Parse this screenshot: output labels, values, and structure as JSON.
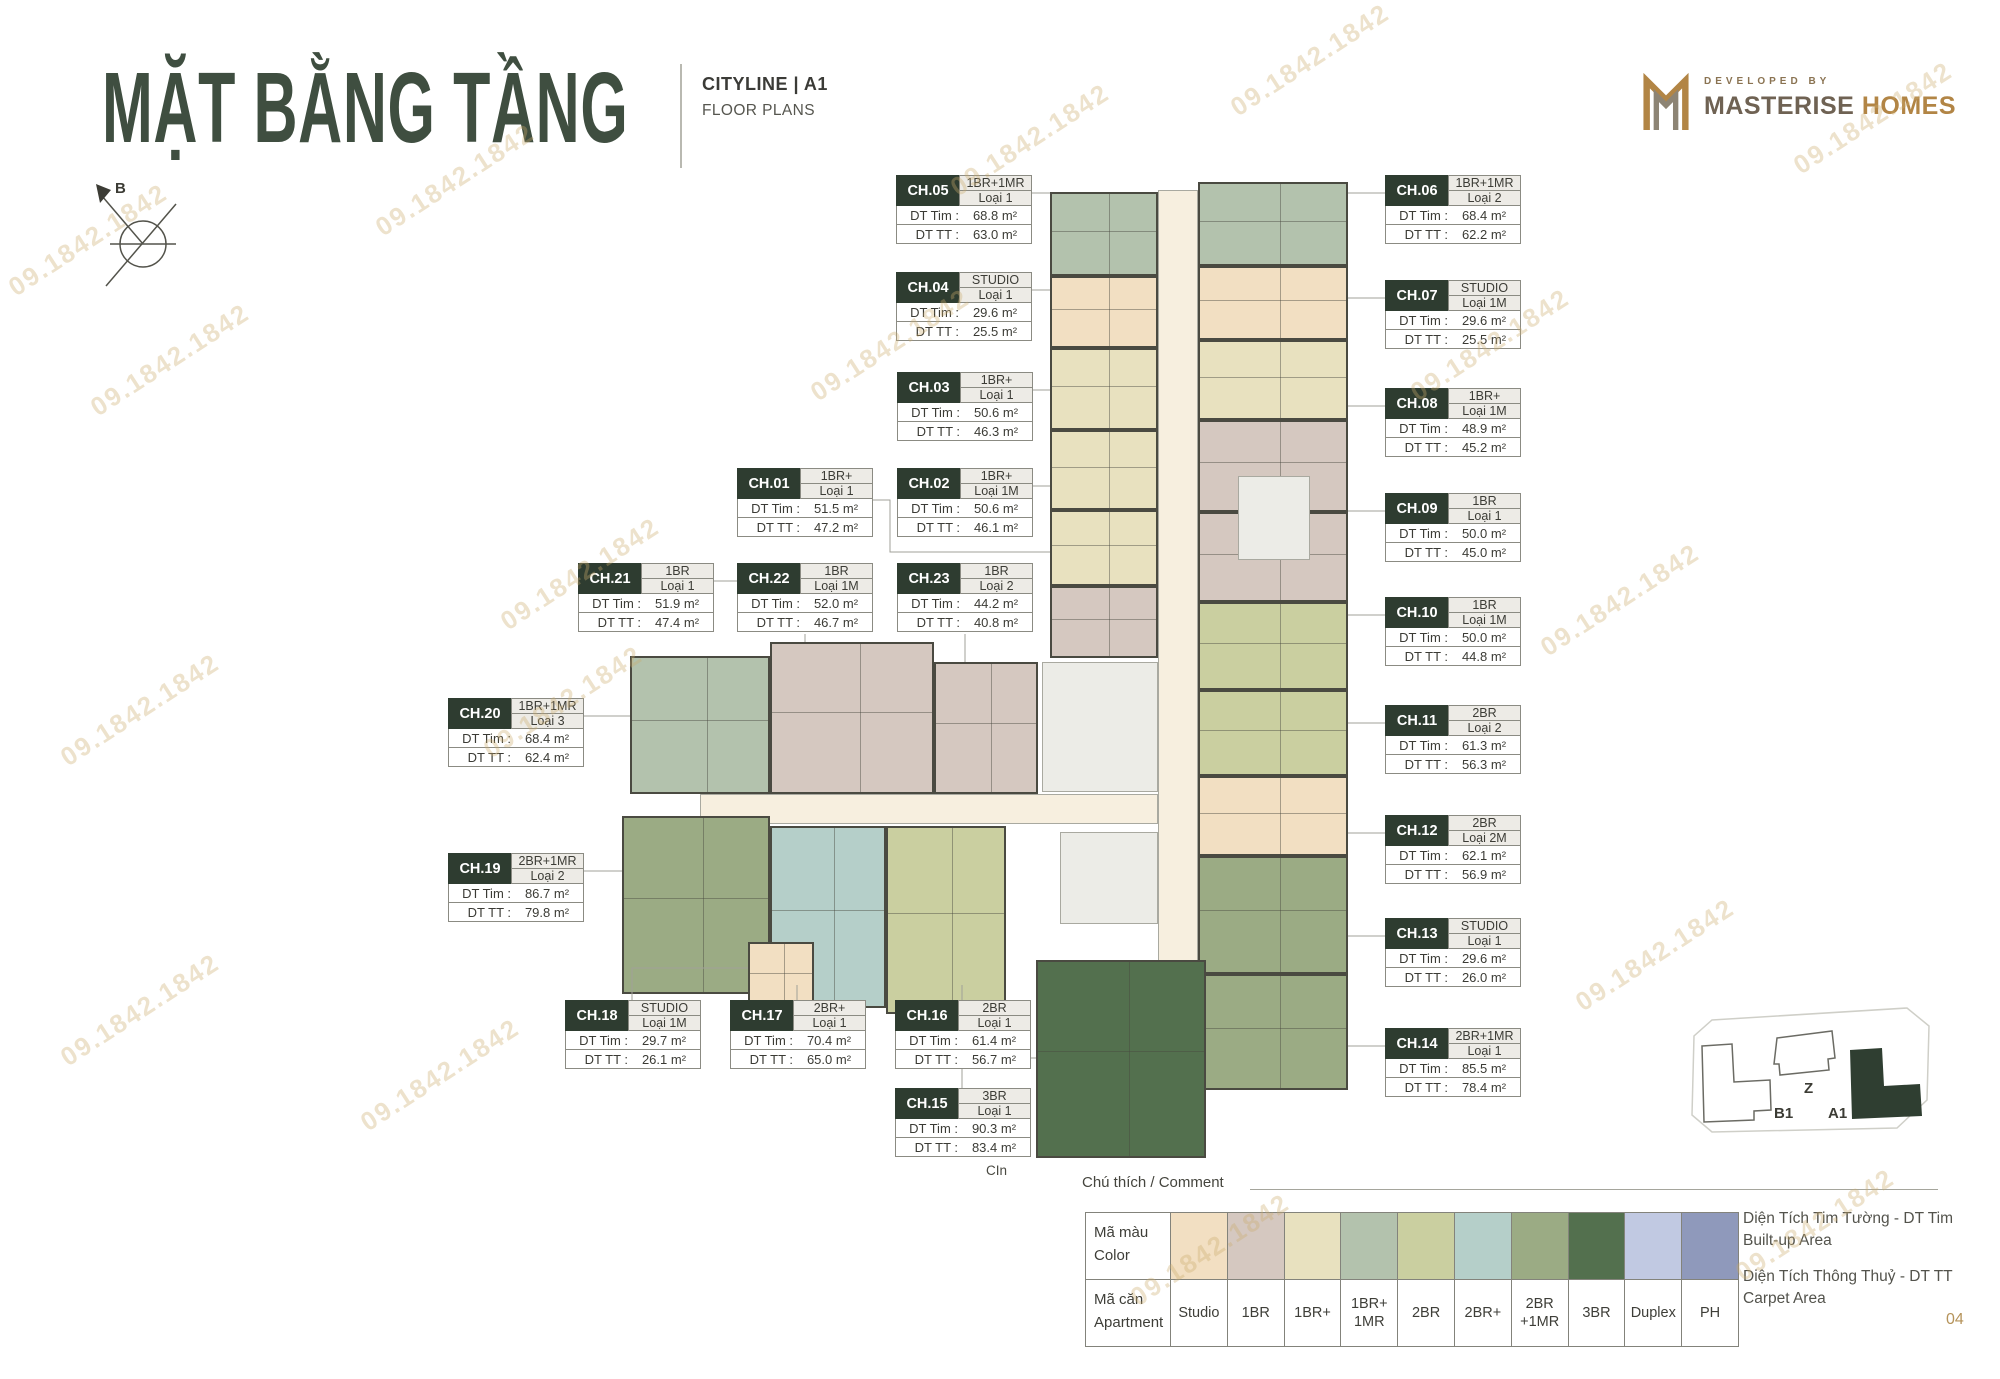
{
  "page": {
    "title": "MẶT BẰNG TẦNG",
    "project": "CITYLINE | A1",
    "subtitle": "FLOOR PLANS",
    "developed_by": "DEVELOPED BY",
    "brand_primary": "MASTERISE",
    "brand_secondary": "HOMES",
    "compass_label": "B",
    "watermark_text": "09.1842.1842",
    "plan_note": "CIn",
    "page_number": "04",
    "accent_dark_green": "#2e3c30",
    "accent_gold": "#b28545"
  },
  "labels": {
    "dt_tim": "DT Tim :",
    "dt_tt": "DT TT :"
  },
  "units": [
    {
      "code": "CH.05",
      "type": "1BR+1MR",
      "variant": "Loại 1",
      "dt_tim": "68.8 m²",
      "dt_tt": "63.0 m²"
    },
    {
      "code": "CH.04",
      "type": "STUDIO",
      "variant": "Loại 1",
      "dt_tim": "29.6 m²",
      "dt_tt": "25.5 m²"
    },
    {
      "code": "CH.03",
      "type": "1BR+",
      "variant": "Loại 1",
      "dt_tim": "50.6 m²",
      "dt_tt": "46.3 m²"
    },
    {
      "code": "CH.01",
      "type": "1BR+",
      "variant": "Loại 1",
      "dt_tim": "51.5 m²",
      "dt_tt": "47.2 m²"
    },
    {
      "code": "CH.02",
      "type": "1BR+",
      "variant": "Loại 1M",
      "dt_tim": "50.6 m²",
      "dt_tt": "46.1 m²"
    },
    {
      "code": "CH.21",
      "type": "1BR",
      "variant": "Loại 1",
      "dt_tim": "51.9 m²",
      "dt_tt": "47.4 m²"
    },
    {
      "code": "CH.22",
      "type": "1BR",
      "variant": "Loại 1M",
      "dt_tim": "52.0 m²",
      "dt_tt": "46.7 m²"
    },
    {
      "code": "CH.23",
      "type": "1BR",
      "variant": "Loại 2",
      "dt_tim": "44.2 m²",
      "dt_tt": "40.8 m²"
    },
    {
      "code": "CH.20",
      "type": "1BR+1MR",
      "variant": "Loại 3",
      "dt_tim": "68.4 m²",
      "dt_tt": "62.4 m²"
    },
    {
      "code": "CH.19",
      "type": "2BR+1MR",
      "variant": "Loại 2",
      "dt_tim": "86.7 m²",
      "dt_tt": "79.8 m²"
    },
    {
      "code": "CH.18",
      "type": "STUDIO",
      "variant": "Loại 1M",
      "dt_tim": "29.7 m²",
      "dt_tt": "26.1 m²"
    },
    {
      "code": "CH.17",
      "type": "2BR+",
      "variant": "Loại 1",
      "dt_tim": "70.4 m²",
      "dt_tt": "65.0 m²"
    },
    {
      "code": "CH.16",
      "type": "2BR",
      "variant": "Loại 1",
      "dt_tim": "61.4 m²",
      "dt_tt": "56.7 m²"
    },
    {
      "code": "CH.15",
      "type": "3BR",
      "variant": "Loại 1",
      "dt_tim": "90.3 m²",
      "dt_tt": "83.4 m²"
    },
    {
      "code": "CH.06",
      "type": "1BR+1MR",
      "variant": "Loại 2",
      "dt_tim": "68.4 m²",
      "dt_tt": "62.2 m²"
    },
    {
      "code": "CH.07",
      "type": "STUDIO",
      "variant": "Loại 1M",
      "dt_tim": "29.6 m²",
      "dt_tt": "25.5 m²"
    },
    {
      "code": "CH.08",
      "type": "1BR+",
      "variant": "Loại 1M",
      "dt_tim": "48.9 m²",
      "dt_tt": "45.2 m²"
    },
    {
      "code": "CH.09",
      "type": "1BR",
      "variant": "Loại 1",
      "dt_tim": "50.0 m²",
      "dt_tt": "45.0 m²"
    },
    {
      "code": "CH.10",
      "type": "1BR",
      "variant": "Loại 1M",
      "dt_tim": "50.0 m²",
      "dt_tt": "44.8 m²"
    },
    {
      "code": "CH.11",
      "type": "2BR",
      "variant": "Loại 2",
      "dt_tim": "61.3 m²",
      "dt_tt": "56.3 m²"
    },
    {
      "code": "CH.12",
      "type": "2BR",
      "variant": "Loại 2M",
      "dt_tim": "62.1 m²",
      "dt_tt": "56.9 m²"
    },
    {
      "code": "CH.13",
      "type": "STUDIO",
      "variant": "Loại 1",
      "dt_tim": "29.6 m²",
      "dt_tt": "26.0 m²"
    },
    {
      "code": "CH.14",
      "type": "2BR+1MR",
      "variant": "Loại 1",
      "dt_tim": "85.5 m²",
      "dt_tt": "78.4 m²"
    }
  ],
  "legend": {
    "header": "Chú thích / Comment",
    "color_row_label_vi": "Mã màu",
    "color_row_label_en": "Color",
    "apt_row_label_vi": "Mã căn",
    "apt_row_label_en": "Apartment",
    "items": [
      {
        "label": "Studio",
        "color": "#f2dfc2"
      },
      {
        "label": "1BR",
        "color": "#d5c8c0"
      },
      {
        "label": "1BR+",
        "color": "#e8e1bf"
      },
      {
        "label": "1BR+\n1MR",
        "color": "#b3c2ad"
      },
      {
        "label": "2BR",
        "color": "#cacfa0"
      },
      {
        "label": "2BR+",
        "color": "#b5cfc9"
      },
      {
        "label": "2BR\n+1MR",
        "color": "#9bab84"
      },
      {
        "label": "3BR",
        "color": "#53704e"
      },
      {
        "label": "Duplex",
        "color": "#c1c9e2"
      },
      {
        "label": "PH",
        "color": "#8f99bb"
      }
    ],
    "note_builtup_vi": "Diện Tích Tim Tường - DT Tim",
    "note_builtup_en": "Built-up Area",
    "note_carpet_vi": "Diện Tích Thông Thuỷ - DT TT",
    "note_carpet_en": "Carpet Area"
  },
  "site_key": {
    "b1": "B1",
    "z": "Z",
    "a1": "A1"
  },
  "floor_plan": {
    "corridor_color": "#f7efdf",
    "core_color": "#ecece7",
    "blocks": [
      [
        1158,
        190,
        40,
        940,
        "corridor"
      ],
      [
        700,
        794,
        458,
        30,
        "corridor"
      ],
      [
        1050,
        192,
        108,
        84,
        3
      ],
      [
        1050,
        276,
        108,
        72,
        0
      ],
      [
        1050,
        348,
        108,
        82,
        2
      ],
      [
        1050,
        430,
        108,
        80,
        2
      ],
      [
        1050,
        510,
        108,
        76,
        2
      ],
      [
        1050,
        586,
        108,
        72,
        1
      ],
      [
        1198,
        182,
        150,
        84,
        3
      ],
      [
        1198,
        266,
        150,
        74,
        0
      ],
      [
        1198,
        340,
        150,
        80,
        2
      ],
      [
        1198,
        420,
        150,
        92,
        1
      ],
      [
        1198,
        512,
        150,
        90,
        1
      ],
      [
        1198,
        602,
        150,
        88,
        4
      ],
      [
        1198,
        690,
        150,
        86,
        4
      ],
      [
        1198,
        776,
        150,
        80,
        0
      ],
      [
        1198,
        856,
        150,
        118,
        6
      ],
      [
        1198,
        974,
        150,
        116,
        6
      ],
      [
        630,
        656,
        140,
        138,
        3
      ],
      [
        770,
        642,
        164,
        152,
        1
      ],
      [
        934,
        662,
        104,
        132,
        1
      ],
      [
        622,
        816,
        148,
        178,
        6
      ],
      [
        770,
        826,
        116,
        182,
        5
      ],
      [
        886,
        826,
        120,
        188,
        4
      ],
      [
        1238,
        476,
        72,
        84,
        "core"
      ],
      [
        1042,
        662,
        116,
        130,
        "core"
      ],
      [
        1060,
        832,
        98,
        92,
        "core"
      ],
      [
        1036,
        960,
        170,
        198,
        7
      ],
      [
        748,
        942,
        66,
        66,
        0
      ]
    ]
  }
}
